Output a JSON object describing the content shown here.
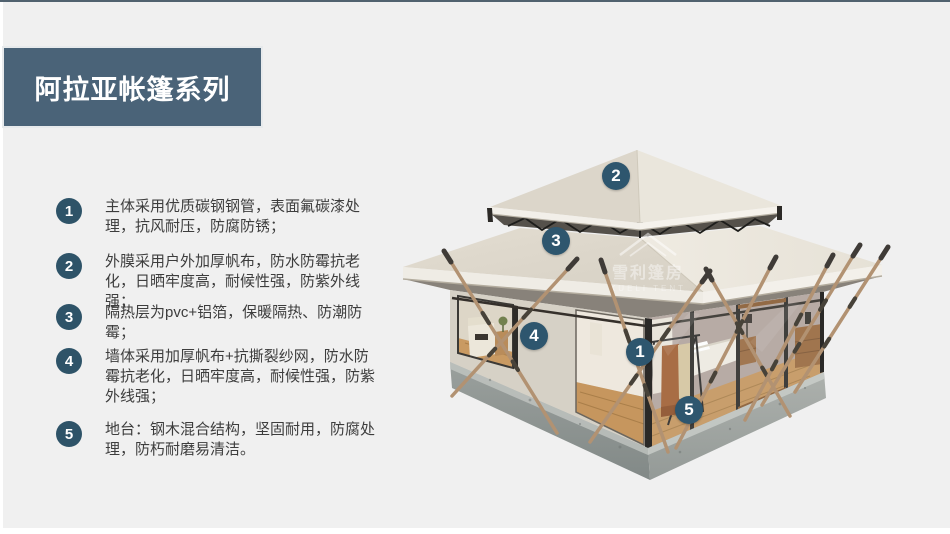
{
  "page": {
    "background_color": "#f0f0f0",
    "accent_color": "#2e566e",
    "banner_color": "#4a6378"
  },
  "header": {
    "title": "阿拉亚帐篷系列"
  },
  "features": {
    "items": [
      {
        "num": "1",
        "text": "主体采用优质碳钢钢管，表面氟碳漆处理，抗风耐压，防腐防锈；"
      },
      {
        "num": "2",
        "text": "外膜采用户外加厚帆布，防水防霉抗老化，日晒牢度高，耐候性强，防紫外线强；"
      },
      {
        "num": "3",
        "text": "隔热层为pvc+铝箔，保暖隔热、防潮防霉；"
      },
      {
        "num": "4",
        "text": "墙体采用加厚帆布+抗撕裂纱网，防水防霉抗老化，日晒牢度高，耐候性强，防紫外线强；"
      },
      {
        "num": "5",
        "text": "地台：钢木混合结构，坚固耐用，防腐处理，防朽耐磨易清洁。"
      }
    ]
  },
  "tent": {
    "markers": [
      {
        "num": "1"
      },
      {
        "num": "2"
      },
      {
        "num": "3"
      },
      {
        "num": "4"
      },
      {
        "num": "5"
      }
    ],
    "watermark": {
      "cn": "雪利篷房",
      "en": "XUELI TENT"
    }
  }
}
